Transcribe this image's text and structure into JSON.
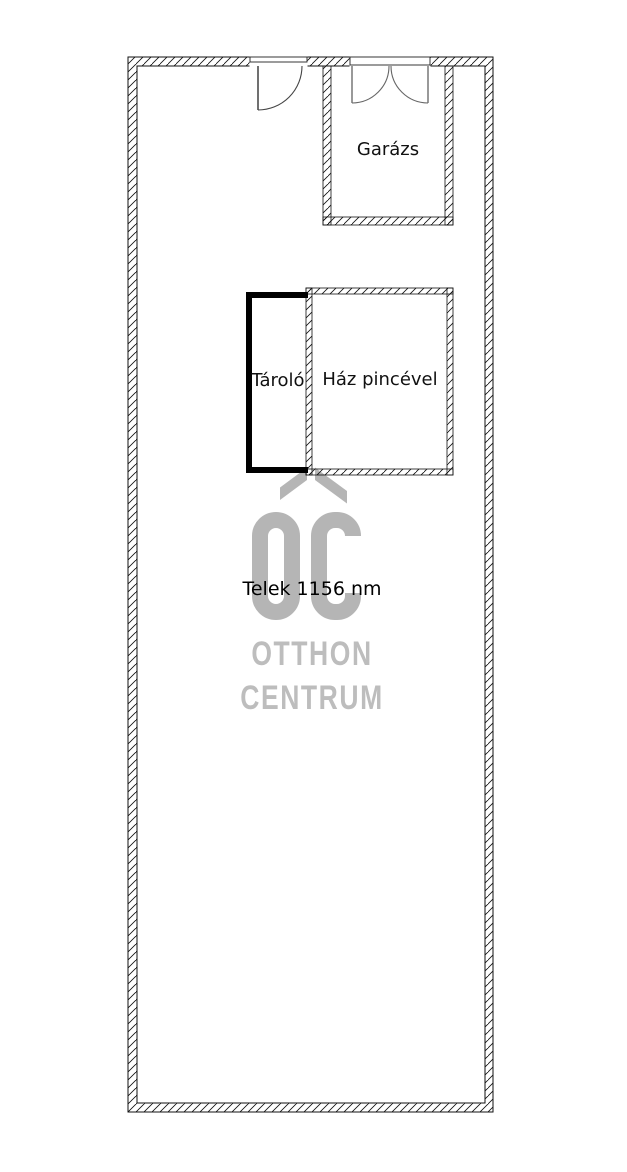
{
  "rooms": {
    "garage": {
      "label": "Garázs"
    },
    "storage": {
      "label": "Tároló"
    },
    "house": {
      "label": "Ház pincével"
    }
  },
  "plot": {
    "label": "Telek 1156 nm"
  },
  "watermark": {
    "monogram": "OC",
    "line1": "OTTHON",
    "line2": "CENTRUM",
    "shape_color": "#b5b5b5",
    "text_color": "#bdbdbd"
  },
  "colors": {
    "background": "#ffffff",
    "wall_outline": "#111111",
    "solid_wall": "#000000",
    "door_leaf": "#999999",
    "door_arc": "#666666",
    "label_text": "#111111"
  }
}
